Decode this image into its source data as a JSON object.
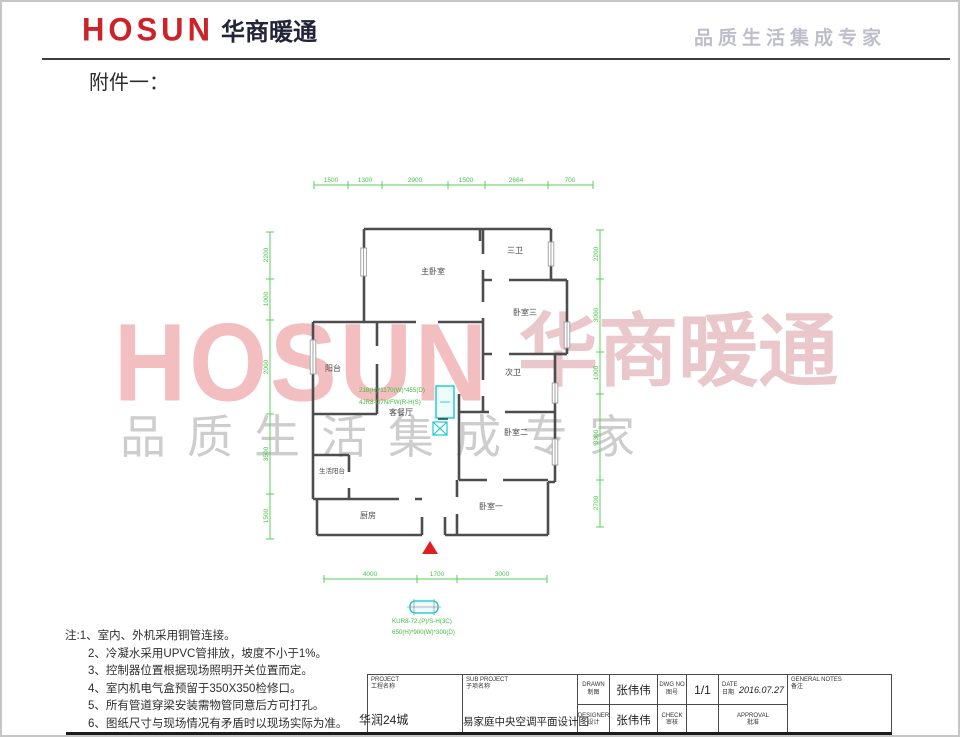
{
  "header": {
    "logo_en": "HOSUN",
    "logo_cn": "华商暖通",
    "tagline": "品质生活集成专家"
  },
  "attachment_label": "附件一：",
  "watermark": {
    "logo_en": "HOSUN",
    "logo_cn": "华商暖通",
    "tagline": "品质生活集成专家"
  },
  "plan": {
    "rooms": [
      "主卧室",
      "三卫",
      "卧室三",
      "次卫",
      "卧室二",
      "卧室一",
      "阳台",
      "客餐厅",
      "生活阳台",
      "厨房"
    ],
    "dims": {
      "top": [
        "1500",
        "1300",
        "2900",
        "1500",
        "2664",
        "700"
      ],
      "left": [
        "2200",
        "1000",
        "2000",
        "3500",
        "1500"
      ],
      "right": [
        "2200",
        "3000",
        "1000",
        "3300",
        "2700"
      ],
      "bottom": [
        "4000",
        "1700",
        "3000"
      ]
    },
    "indoor_unit_spec": [
      "218(H)*1170(W)*455(D)",
      "4JR8-G7N/FW(R-H(S)"
    ],
    "outdoor_unit_spec": [
      "KUR8-72.(P)/S-H(3C)",
      "650(H)*900(W)*300(D)"
    ]
  },
  "notes": {
    "lines": [
      "注:1、室内、外机采用铜管连接。",
      "2、冷凝水采用UPVC管排放，坡度不小于1%。",
      "3、控制器位置根据现场照明开关位置而定。",
      "4、室内机电气盒预留于350X350检修口。",
      "5、所有管道穿梁安装需物管同意后方可打孔。",
      "6、图纸尺寸与现场情况有矛盾时以现场实际为准。"
    ]
  },
  "titleblock": {
    "project_en": "PROJECT",
    "project_cn": "工程名称",
    "project_value": "华润24城",
    "subproject_en": "SUB PROJECT",
    "subproject_cn": "子项名称",
    "subproject_value": "易家庭中央空调平面设计图",
    "drawn_en": "DRAWN",
    "drawn_cn": "制图",
    "drawn_value": "张伟伟",
    "designer_en": "DESIGNER",
    "designer_cn": "设计",
    "designer_value": "张伟伟",
    "dwgno_en": "DWG NO",
    "dwgno_cn": "图号",
    "dwgno_value": "1/1",
    "check_en": "CHECK",
    "check_cn": "审核",
    "check_value": "",
    "date_en": "DATE",
    "date_cn": "日期",
    "date_value": "2016.07.27",
    "approval_en": "APPROVAL",
    "approval_cn": "批准",
    "approval_value": "",
    "notes_en": "GENERAL NOTES",
    "notes_cn": "备注"
  },
  "colors": {
    "brand_red": "#cc2229",
    "dimension_green": "#5ad05a",
    "unit_cyan": "#00c8c8",
    "entrance_red": "#e01f1f"
  }
}
